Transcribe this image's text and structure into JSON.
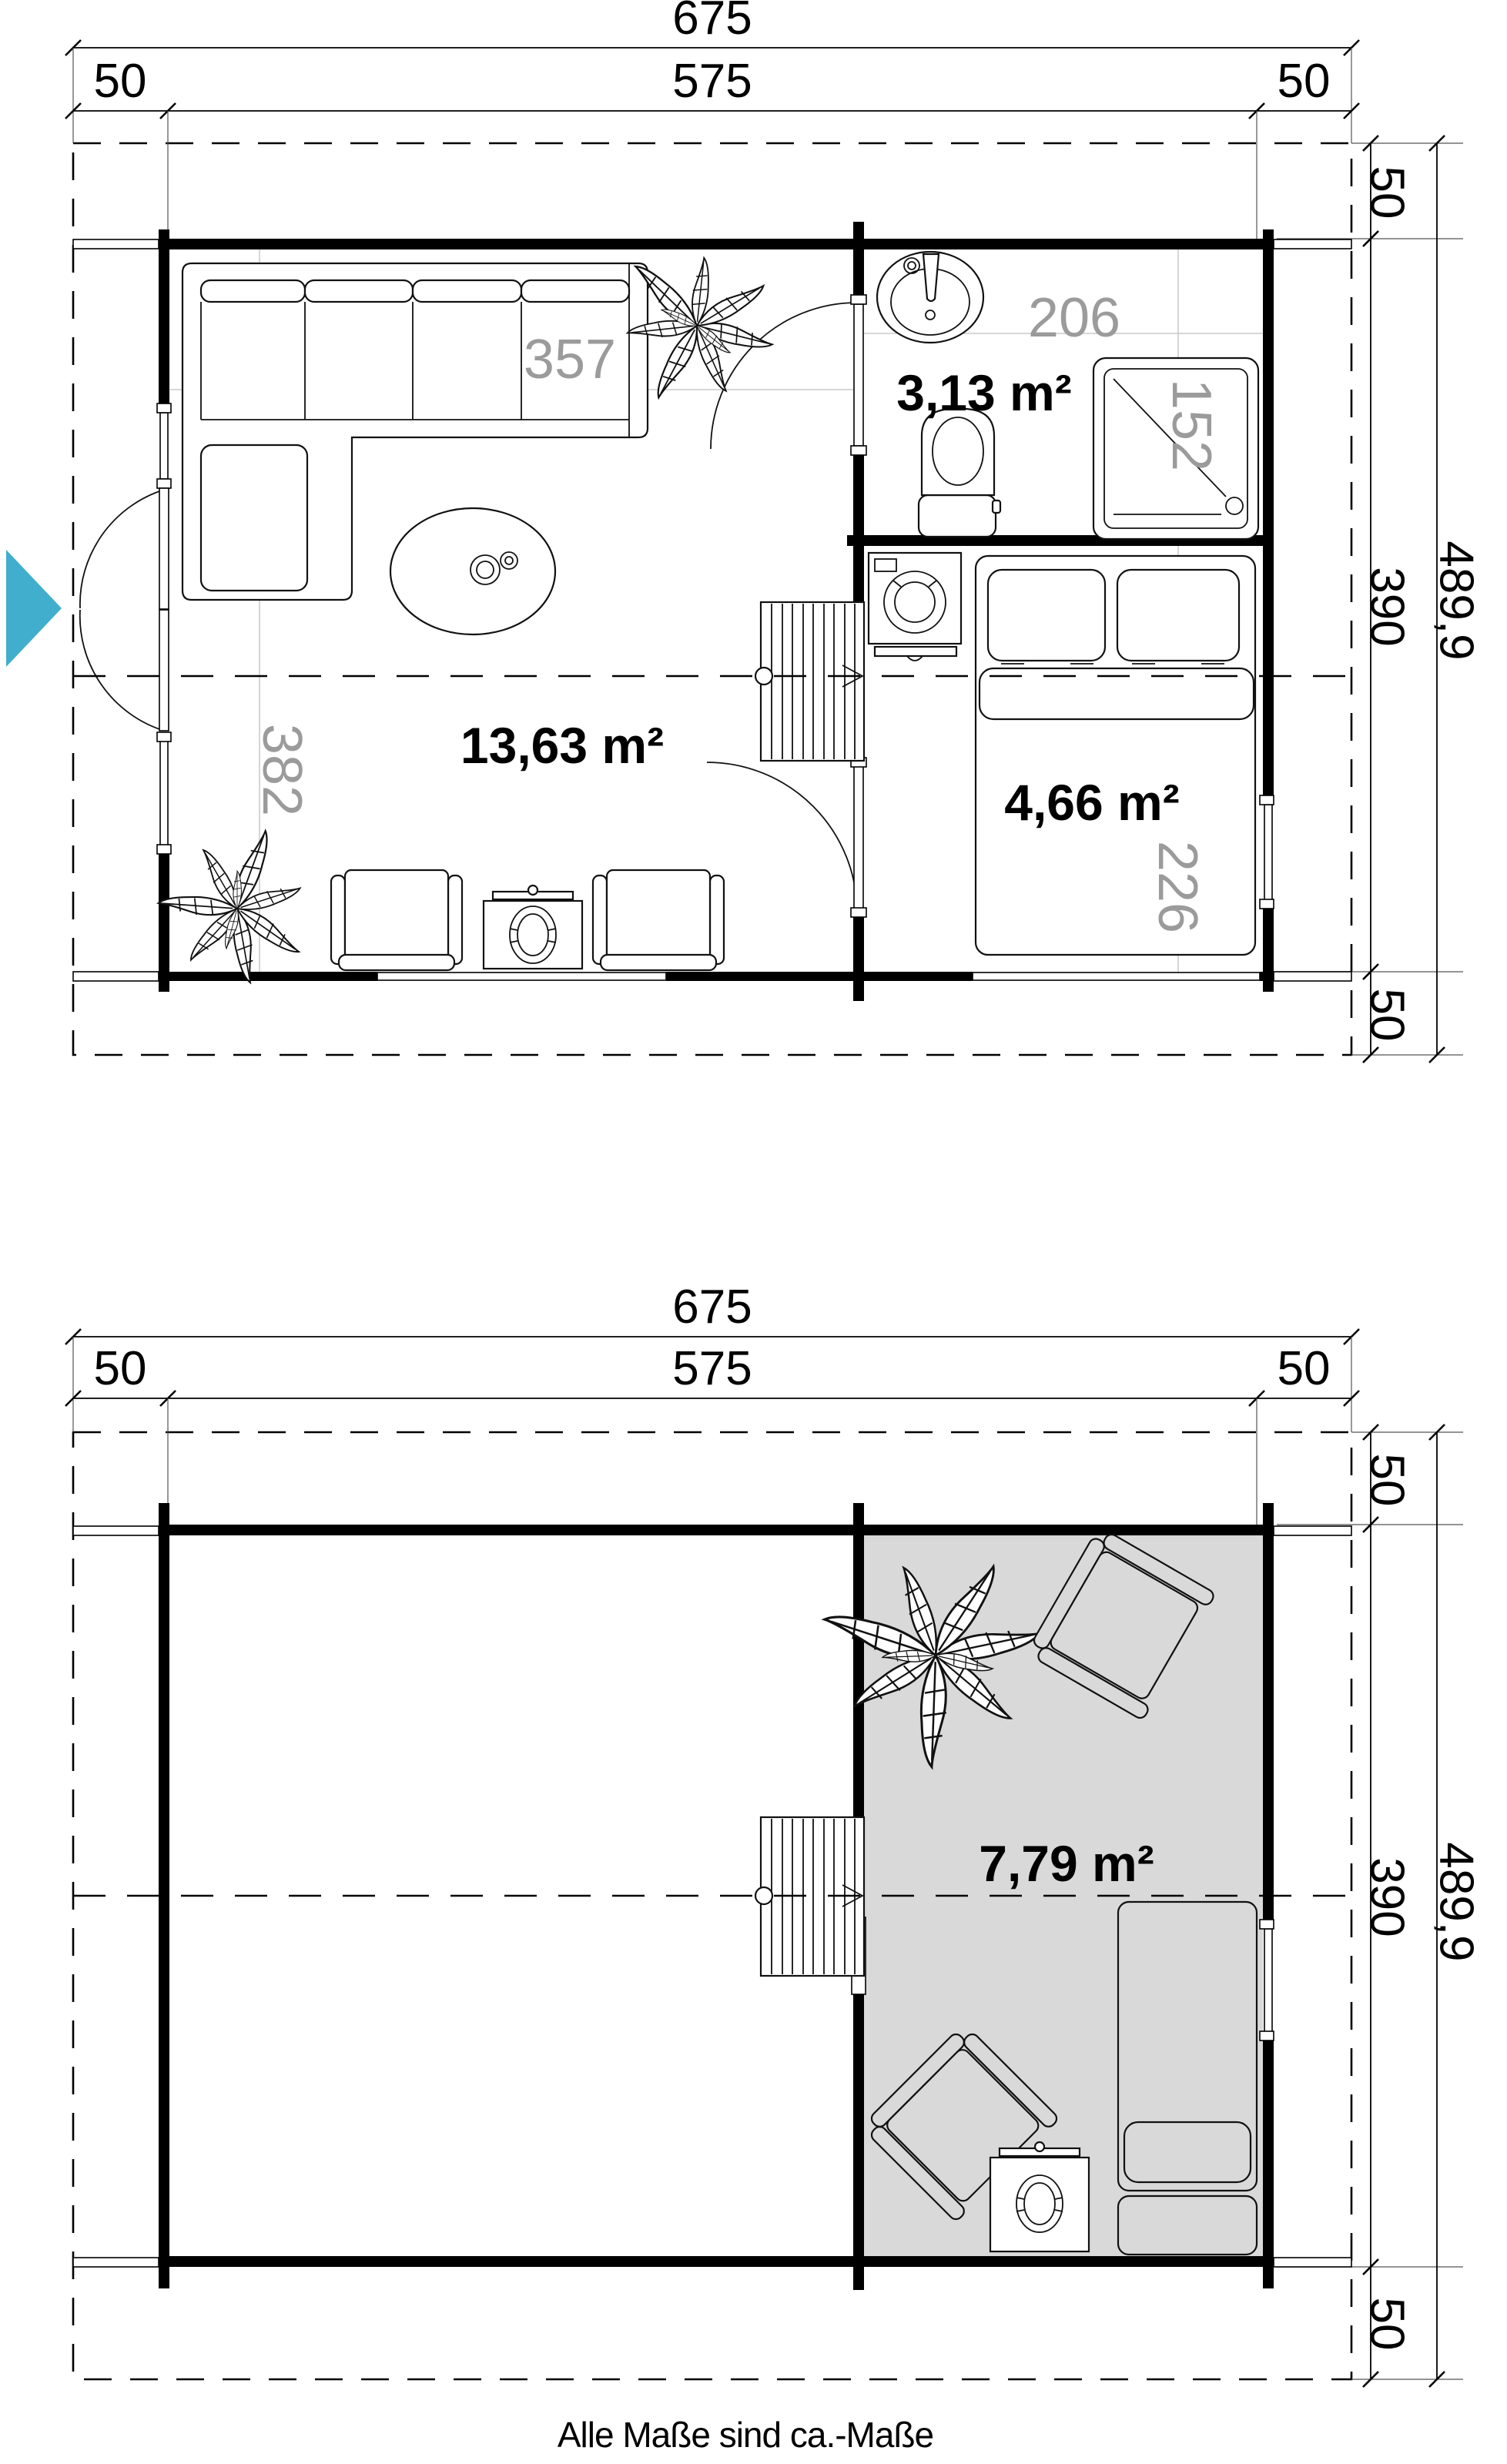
{
  "colors": {
    "entrance_arrow": "#41aecd",
    "loft_fill": "#d9d9d9",
    "dim_gray": "#9b9b9b",
    "line": "#000000"
  },
  "ground_floor": {
    "dim_total_width": "675",
    "dim_side_left": "50",
    "dim_main_width": "575",
    "dim_side_right": "50",
    "dim_total_depth": "489,9",
    "dim_depth_top": "50",
    "dim_main_depth": "390",
    "dim_depth_bottom": "50",
    "living_area": "13,63 m²",
    "living_width": "357",
    "living_depth": "382",
    "bath_area": "3,13 m²",
    "bath_width": "206",
    "bath_depth": "152",
    "bedroom_area": "4,66 m²",
    "bedroom_depth": "226"
  },
  "upper_floor": {
    "dim_total_width": "675",
    "dim_side_left": "50",
    "dim_main_width": "575",
    "dim_side_right": "50",
    "dim_total_depth": "489,9",
    "dim_depth_top": "50",
    "dim_main_depth": "390",
    "dim_depth_bottom": "50",
    "loft_area": "7,79 m²"
  },
  "footer": {
    "note": "Alle Maße sind ca.-Maße"
  }
}
